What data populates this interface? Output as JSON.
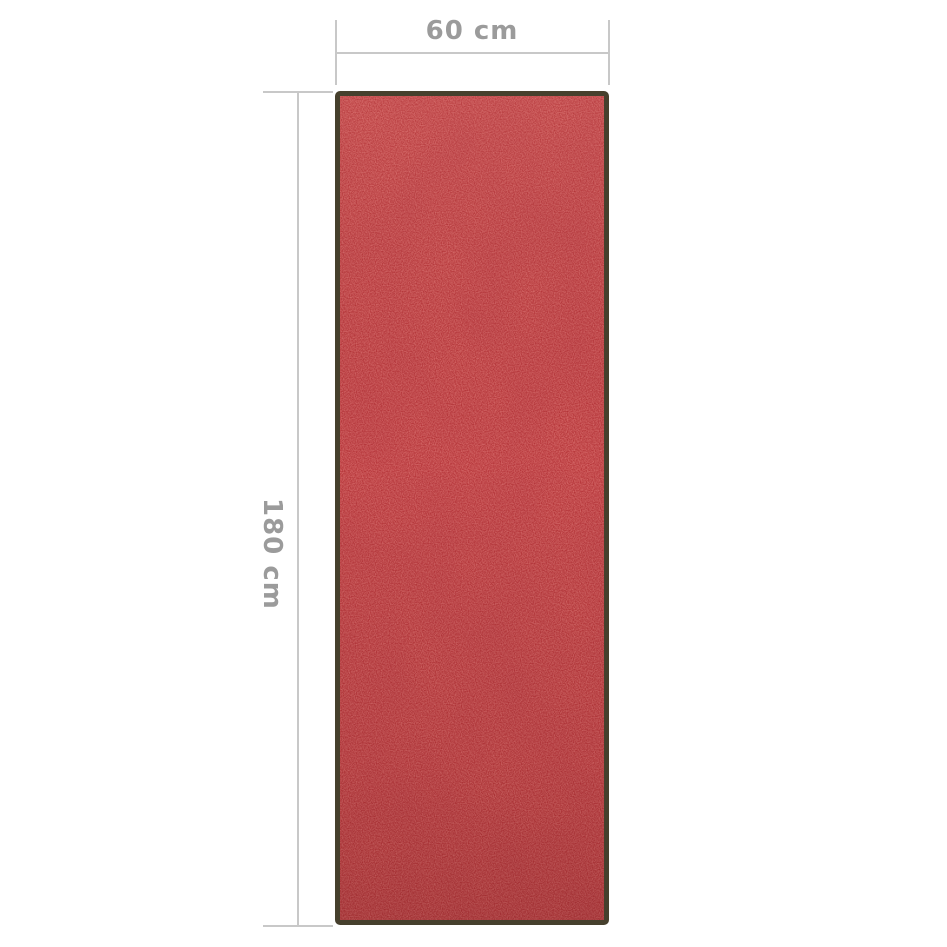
{
  "product": {
    "description": "red washable doormat with dark frame border, shown front-on"
  },
  "dimensions": {
    "width": {
      "label": "60 cm"
    },
    "height": {
      "label": "180 cm"
    }
  },
  "colors": {
    "bg-color": "#ffffff",
    "line-color": "#c8c8c8",
    "dim-text-color": "#9b9b9b",
    "mat-base-color": "#a81d22",
    "mat-speckle-color": "#dd4f4b",
    "mat-border-color": "#46402d"
  }
}
